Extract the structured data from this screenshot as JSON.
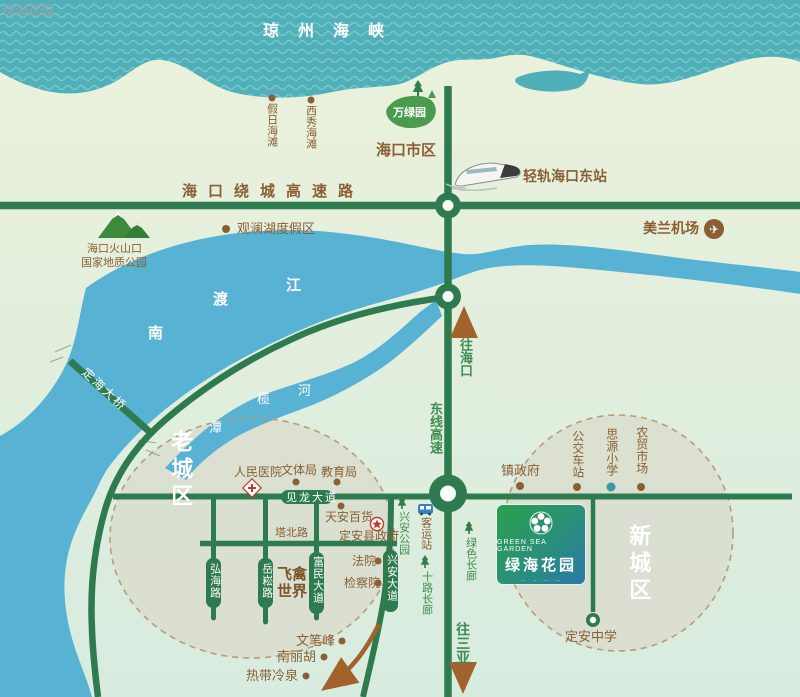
{
  "watermark": "绿海花园",
  "sea": {
    "name": "琼州海峡"
  },
  "beaches": {
    "holiday": "假日海滩",
    "xixiu": "西秀海滩"
  },
  "city": {
    "haikou": "海口市区"
  },
  "parks": {
    "wanlv": "万绿园",
    "xingan_park": "兴安公园",
    "green_corridor": "绿色长廊",
    "shilu_corridor": "十路长廊"
  },
  "transport": {
    "light_rail": "轻轨海口东站",
    "airport": "美兰机场",
    "ring_expressway": "海口绕城高速路",
    "east_expressway": "东线高速",
    "to_haikou": "往海口",
    "to_sanya": "往三亚",
    "coach_station": "客运站",
    "bus_stop": "公交车站",
    "dinghai_bridge": "定海大桥"
  },
  "nature": {
    "volcano_line1": "海口火山口",
    "volcano_line2": "国家地质公园",
    "guanlanhu": "观澜湖度假区",
    "nandu_chars": [
      "南",
      "渡",
      "江"
    ],
    "tanlan_chars": [
      "潭",
      "榄",
      "河"
    ],
    "wenbi_peak": "文笔峰",
    "nanlihu": "南丽胡",
    "hot_spring": "热带冷泉",
    "bird_world": "飞禽世界"
  },
  "districts": {
    "old": "老城区",
    "new": "新城区"
  },
  "roads": {
    "jianlong": "见龙大道",
    "tabei": "塔北路",
    "honghai": "弘海路",
    "yuesong": "岳崧路",
    "fumin": "富民大道",
    "xingan": "兴安大道"
  },
  "pois": {
    "hospital": "人民医院",
    "sports_bureau": "文体局",
    "education_bureau": "教育局",
    "tianan_store": "天安百货",
    "county_gov": "定安县政府",
    "court": "法院",
    "procuratorate": "检察院",
    "town_gov": "镇政府",
    "siyuan_school": "思源小学",
    "farmers_market": "农贸市场",
    "dingan_school": "定安中学"
  },
  "logo": {
    "en": "GREEN SEA GARDEN",
    "cn": "绿海花园",
    "tagline": "— · — · — · —"
  },
  "icons": {
    "plane": "✈"
  },
  "colors": {
    "sea": "#4fb0ba",
    "sea_wave": "#79c6cb",
    "river": "#57b2d4",
    "land_north": "#ecf2db",
    "land_south": "#d7ebdf",
    "road_green": "#2e7b50",
    "label_brown": "#8a5f33",
    "label_green": "#3f8d53",
    "district_fill": "#d9dccd",
    "district_dash": "#b99b79",
    "logo_green": "#2aa04c",
    "logo_blue": "#2779ab",
    "marker_red": "#c23b2e",
    "marker_teal": "#3f98a6",
    "arrow_brown": "#a2622c"
  }
}
